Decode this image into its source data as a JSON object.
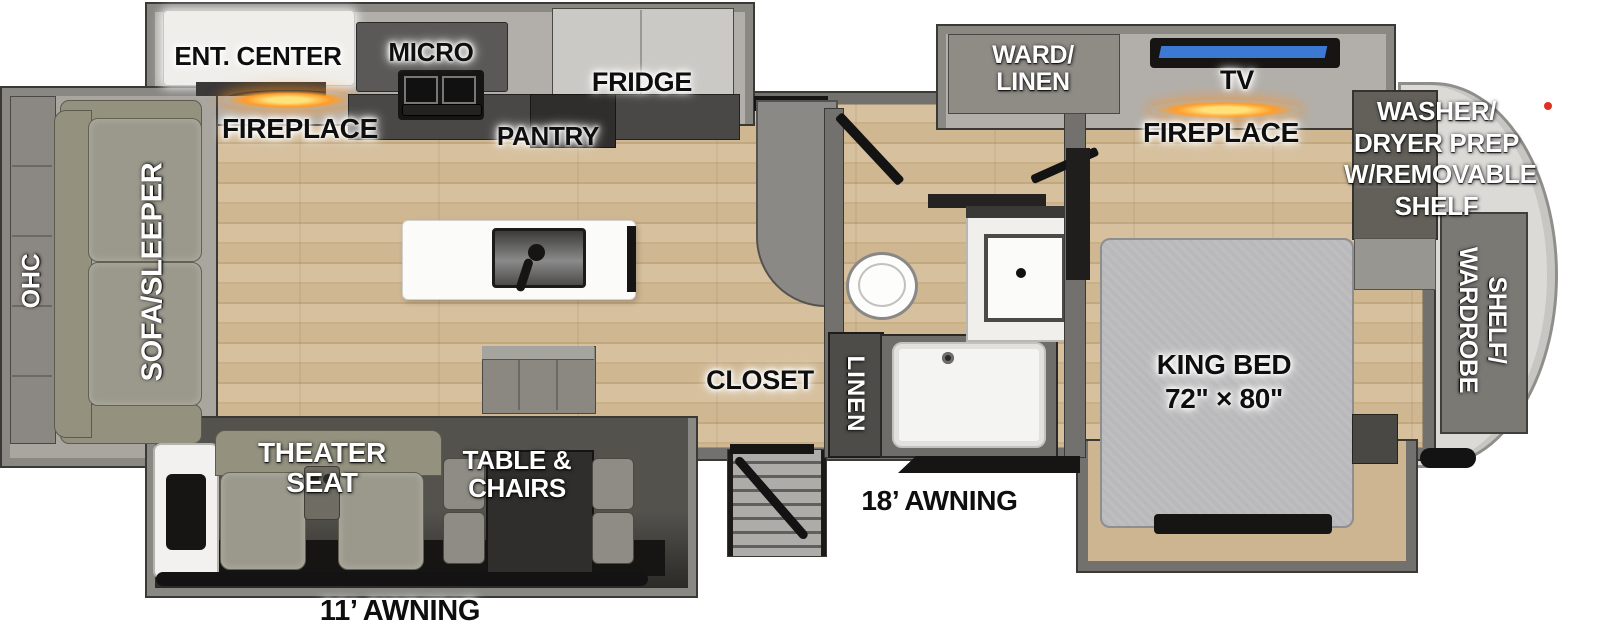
{
  "colors": {
    "wall": "#73716d",
    "floor_wood": "#cdb592",
    "fireplace_glow": "#ff9d2a",
    "tv_screen": "#3b79d2",
    "marker_light": "#e03020"
  },
  "floorplan": {
    "rear_slide": {
      "ohc": "OHC",
      "sofa": "SOFA/SLEEPER"
    },
    "kitchen": {
      "ent_center": "ENT. CENTER",
      "fireplace": "FIREPLACE",
      "micro": "MICRO",
      "pantry": "PANTRY",
      "fridge": "FRIDGE"
    },
    "living": {
      "theater_seat": "THEATER SEAT",
      "table_chairs": "TABLE & CHAIRS"
    },
    "entry": {
      "closet": "CLOSET"
    },
    "bath": {
      "linen": "LINEN"
    },
    "bedroom": {
      "ward_linen": [
        "WARD/",
        "LINEN"
      ],
      "tv": "TV",
      "fireplace": "FIREPLACE",
      "king_bed": [
        "KING BED",
        "72\" × 80\""
      ]
    },
    "front_storage": {
      "washer_dryer": [
        "WASHER/",
        "DRYER PREP",
        "W/REMOVABLE",
        "SHELF"
      ],
      "shelf_wardrobe": [
        "SHELF/",
        "WARDROBE"
      ]
    },
    "awnings": {
      "left": "11’ AWNING",
      "right": "18’ AWNING"
    }
  }
}
